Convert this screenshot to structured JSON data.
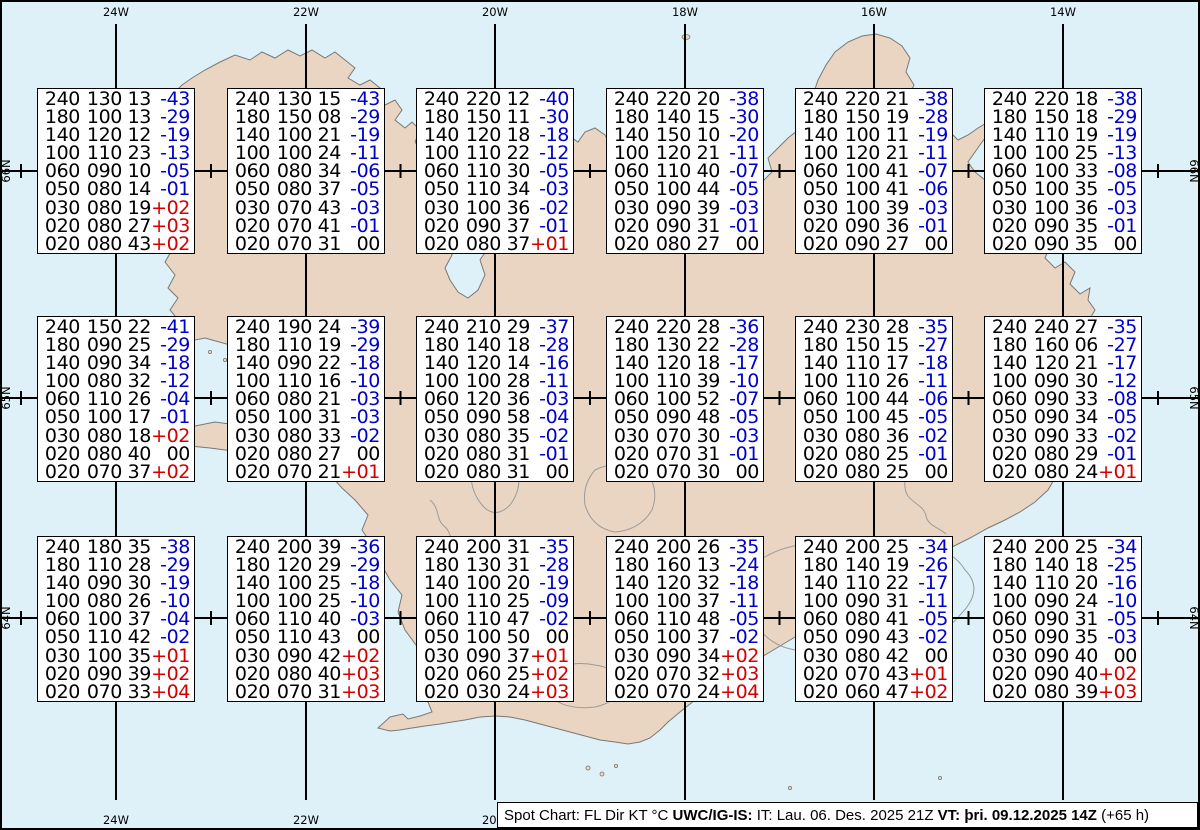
{
  "map": {
    "sea_color": "#def1f8",
    "land_color": "#e9d5c1",
    "coast_color": "#787878",
    "glacier_color": "#9b9b9b",
    "grid_color": "#000000",
    "meridians": [
      {
        "label": "24W",
        "x": 116,
        "bottom_label": true
      },
      {
        "label": "22W",
        "x": 306,
        "bottom_label": true
      },
      {
        "label": "20W",
        "x": 495,
        "bottom_label": true
      },
      {
        "label": "18W",
        "x": 685,
        "bottom_label": false
      },
      {
        "label": "16W",
        "x": 874,
        "bottom_label": false
      },
      {
        "label": "14W",
        "x": 1063,
        "bottom_label": false
      }
    ],
    "parallels": [
      {
        "label": "66N",
        "y": 171
      },
      {
        "label": "65N",
        "y": 398
      },
      {
        "label": "64N",
        "y": 618
      }
    ]
  },
  "columns": [
    "FL",
    "Dir",
    "KT",
    "°C"
  ],
  "stations": [
    {
      "x": 37,
      "y": 88,
      "rows": [
        [
          "240",
          "130",
          "13",
          "-43"
        ],
        [
          "180",
          "100",
          "13",
          "-29"
        ],
        [
          "140",
          "120",
          "12",
          "-19"
        ],
        [
          "100",
          "110",
          "23",
          "-13"
        ],
        [
          "060",
          "090",
          "10",
          "-05"
        ],
        [
          "050",
          "080",
          "14",
          "-01"
        ],
        [
          "030",
          "080",
          "19",
          "+02"
        ],
        [
          "020",
          "080",
          "27",
          "+03"
        ],
        [
          "020",
          "080",
          "43",
          "+02"
        ]
      ]
    },
    {
      "x": 227,
      "y": 88,
      "rows": [
        [
          "240",
          "130",
          "15",
          "-43"
        ],
        [
          "180",
          "150",
          "08",
          "-29"
        ],
        [
          "140",
          "100",
          "21",
          "-19"
        ],
        [
          "100",
          "100",
          "24",
          "-11"
        ],
        [
          "060",
          "080",
          "34",
          "-06"
        ],
        [
          "050",
          "080",
          "37",
          "-05"
        ],
        [
          "030",
          "070",
          "43",
          "-03"
        ],
        [
          "020",
          "070",
          "41",
          "-01"
        ],
        [
          "020",
          "070",
          "31",
          "00"
        ]
      ]
    },
    {
      "x": 416,
      "y": 88,
      "rows": [
        [
          "240",
          "220",
          "12",
          "-40"
        ],
        [
          "180",
          "150",
          "11",
          "-30"
        ],
        [
          "140",
          "120",
          "18",
          "-18"
        ],
        [
          "100",
          "110",
          "22",
          "-12"
        ],
        [
          "060",
          "110",
          "30",
          "-05"
        ],
        [
          "050",
          "110",
          "34",
          "-03"
        ],
        [
          "030",
          "100",
          "36",
          "-02"
        ],
        [
          "020",
          "090",
          "37",
          "-01"
        ],
        [
          "020",
          "080",
          "37",
          "+01"
        ]
      ]
    },
    {
      "x": 606,
      "y": 88,
      "rows": [
        [
          "240",
          "220",
          "20",
          "-38"
        ],
        [
          "180",
          "140",
          "15",
          "-30"
        ],
        [
          "140",
          "150",
          "10",
          "-20"
        ],
        [
          "100",
          "120",
          "21",
          "-11"
        ],
        [
          "060",
          "110",
          "40",
          "-07"
        ],
        [
          "050",
          "100",
          "44",
          "-05"
        ],
        [
          "030",
          "090",
          "39",
          "-03"
        ],
        [
          "020",
          "090",
          "31",
          "-01"
        ],
        [
          "020",
          "080",
          "27",
          "00"
        ]
      ]
    },
    {
      "x": 795,
      "y": 88,
      "rows": [
        [
          "240",
          "220",
          "21",
          "-38"
        ],
        [
          "180",
          "150",
          "19",
          "-28"
        ],
        [
          "140",
          "100",
          "11",
          "-19"
        ],
        [
          "100",
          "120",
          "21",
          "-11"
        ],
        [
          "060",
          "100",
          "41",
          "-07"
        ],
        [
          "050",
          "100",
          "41",
          "-06"
        ],
        [
          "030",
          "100",
          "39",
          "-03"
        ],
        [
          "020",
          "090",
          "36",
          "-01"
        ],
        [
          "020",
          "090",
          "27",
          "00"
        ]
      ]
    },
    {
      "x": 984,
      "y": 88,
      "rows": [
        [
          "240",
          "220",
          "18",
          "-38"
        ],
        [
          "180",
          "150",
          "18",
          "-29"
        ],
        [
          "140",
          "110",
          "19",
          "-19"
        ],
        [
          "100",
          "100",
          "25",
          "-13"
        ],
        [
          "060",
          "100",
          "33",
          "-08"
        ],
        [
          "050",
          "100",
          "35",
          "-05"
        ],
        [
          "030",
          "100",
          "36",
          "-03"
        ],
        [
          "020",
          "090",
          "35",
          "-01"
        ],
        [
          "020",
          "090",
          "35",
          "00"
        ]
      ]
    },
    {
      "x": 37,
      "y": 316,
      "rows": [
        [
          "240",
          "150",
          "22",
          "-41"
        ],
        [
          "180",
          "090",
          "25",
          "-29"
        ],
        [
          "140",
          "090",
          "34",
          "-18"
        ],
        [
          "100",
          "080",
          "32",
          "-12"
        ],
        [
          "060",
          "110",
          "26",
          "-04"
        ],
        [
          "050",
          "100",
          "17",
          "-01"
        ],
        [
          "030",
          "080",
          "18",
          "+02"
        ],
        [
          "020",
          "080",
          "40",
          "00"
        ],
        [
          "020",
          "070",
          "37",
          "+02"
        ]
      ]
    },
    {
      "x": 227,
      "y": 316,
      "rows": [
        [
          "240",
          "190",
          "24",
          "-39"
        ],
        [
          "180",
          "110",
          "19",
          "-29"
        ],
        [
          "140",
          "090",
          "22",
          "-18"
        ],
        [
          "100",
          "110",
          "16",
          "-10"
        ],
        [
          "060",
          "080",
          "21",
          "-03"
        ],
        [
          "050",
          "100",
          "31",
          "-03"
        ],
        [
          "030",
          "080",
          "33",
          "-02"
        ],
        [
          "020",
          "080",
          "27",
          "00"
        ],
        [
          "020",
          "070",
          "21",
          "+01"
        ]
      ]
    },
    {
      "x": 416,
      "y": 316,
      "rows": [
        [
          "240",
          "210",
          "29",
          "-37"
        ],
        [
          "180",
          "140",
          "18",
          "-28"
        ],
        [
          "140",
          "120",
          "14",
          "-16"
        ],
        [
          "100",
          "100",
          "28",
          "-11"
        ],
        [
          "060",
          "120",
          "36",
          "-03"
        ],
        [
          "050",
          "090",
          "58",
          "-04"
        ],
        [
          "030",
          "080",
          "35",
          "-02"
        ],
        [
          "020",
          "080",
          "31",
          "-01"
        ],
        [
          "020",
          "080",
          "31",
          "00"
        ]
      ]
    },
    {
      "x": 606,
      "y": 316,
      "rows": [
        [
          "240",
          "220",
          "28",
          "-36"
        ],
        [
          "180",
          "130",
          "22",
          "-28"
        ],
        [
          "140",
          "120",
          "18",
          "-17"
        ],
        [
          "100",
          "110",
          "39",
          "-10"
        ],
        [
          "060",
          "100",
          "52",
          "-07"
        ],
        [
          "050",
          "090",
          "48",
          "-05"
        ],
        [
          "030",
          "070",
          "30",
          "-03"
        ],
        [
          "020",
          "070",
          "31",
          "-01"
        ],
        [
          "020",
          "070",
          "30",
          "00"
        ]
      ]
    },
    {
      "x": 795,
      "y": 316,
      "rows": [
        [
          "240",
          "230",
          "28",
          "-35"
        ],
        [
          "180",
          "150",
          "15",
          "-27"
        ],
        [
          "140",
          "110",
          "17",
          "-18"
        ],
        [
          "100",
          "110",
          "26",
          "-11"
        ],
        [
          "060",
          "100",
          "44",
          "-06"
        ],
        [
          "050",
          "100",
          "45",
          "-05"
        ],
        [
          "030",
          "080",
          "36",
          "-02"
        ],
        [
          "020",
          "080",
          "25",
          "-01"
        ],
        [
          "020",
          "080",
          "25",
          "00"
        ]
      ]
    },
    {
      "x": 984,
      "y": 316,
      "rows": [
        [
          "240",
          "240",
          "27",
          "-35"
        ],
        [
          "180",
          "160",
          "06",
          "-27"
        ],
        [
          "140",
          "120",
          "21",
          "-17"
        ],
        [
          "100",
          "090",
          "30",
          "-12"
        ],
        [
          "060",
          "090",
          "33",
          "-08"
        ],
        [
          "050",
          "090",
          "34",
          "-05"
        ],
        [
          "030",
          "090",
          "33",
          "-02"
        ],
        [
          "020",
          "080",
          "29",
          "-01"
        ],
        [
          "020",
          "080",
          "24",
          "+01"
        ]
      ]
    },
    {
      "x": 37,
      "y": 536,
      "rows": [
        [
          "240",
          "180",
          "35",
          "-38"
        ],
        [
          "180",
          "110",
          "28",
          "-29"
        ],
        [
          "140",
          "090",
          "30",
          "-19"
        ],
        [
          "100",
          "080",
          "26",
          "-10"
        ],
        [
          "060",
          "100",
          "37",
          "-04"
        ],
        [
          "050",
          "110",
          "42",
          "-02"
        ],
        [
          "030",
          "100",
          "35",
          "+01"
        ],
        [
          "020",
          "090",
          "39",
          "+02"
        ],
        [
          "020",
          "070",
          "33",
          "+04"
        ]
      ]
    },
    {
      "x": 227,
      "y": 536,
      "rows": [
        [
          "240",
          "200",
          "39",
          "-36"
        ],
        [
          "180",
          "120",
          "29",
          "-29"
        ],
        [
          "140",
          "100",
          "25",
          "-18"
        ],
        [
          "100",
          "100",
          "25",
          "-10"
        ],
        [
          "060",
          "110",
          "40",
          "-03"
        ],
        [
          "050",
          "110",
          "43",
          "00"
        ],
        [
          "030",
          "090",
          "42",
          "+02"
        ],
        [
          "020",
          "080",
          "40",
          "+03"
        ],
        [
          "020",
          "070",
          "31",
          "+03"
        ]
      ]
    },
    {
      "x": 416,
      "y": 536,
      "rows": [
        [
          "240",
          "200",
          "31",
          "-35"
        ],
        [
          "180",
          "130",
          "31",
          "-28"
        ],
        [
          "140",
          "100",
          "20",
          "-19"
        ],
        [
          "100",
          "110",
          "25",
          "-09"
        ],
        [
          "060",
          "110",
          "47",
          "-02"
        ],
        [
          "050",
          "100",
          "50",
          "00"
        ],
        [
          "030",
          "090",
          "37",
          "+01"
        ],
        [
          "020",
          "060",
          "25",
          "+02"
        ],
        [
          "020",
          "030",
          "24",
          "+03"
        ]
      ]
    },
    {
      "x": 606,
      "y": 536,
      "rows": [
        [
          "240",
          "200",
          "26",
          "-35"
        ],
        [
          "180",
          "160",
          "13",
          "-24"
        ],
        [
          "140",
          "120",
          "32",
          "-18"
        ],
        [
          "100",
          "100",
          "37",
          "-11"
        ],
        [
          "060",
          "110",
          "48",
          "-05"
        ],
        [
          "050",
          "100",
          "37",
          "-02"
        ],
        [
          "030",
          "090",
          "34",
          "+02"
        ],
        [
          "020",
          "070",
          "32",
          "+03"
        ],
        [
          "020",
          "070",
          "24",
          "+04"
        ]
      ]
    },
    {
      "x": 795,
      "y": 536,
      "rows": [
        [
          "240",
          "200",
          "25",
          "-34"
        ],
        [
          "180",
          "140",
          "19",
          "-26"
        ],
        [
          "140",
          "110",
          "22",
          "-17"
        ],
        [
          "100",
          "090",
          "31",
          "-11"
        ],
        [
          "060",
          "080",
          "41",
          "-05"
        ],
        [
          "050",
          "090",
          "43",
          "-02"
        ],
        [
          "030",
          "080",
          "42",
          "00"
        ],
        [
          "020",
          "070",
          "43",
          "+01"
        ],
        [
          "020",
          "060",
          "47",
          "+02"
        ]
      ]
    },
    {
      "x": 984,
      "y": 536,
      "rows": [
        [
          "240",
          "200",
          "25",
          "-34"
        ],
        [
          "180",
          "140",
          "18",
          "-25"
        ],
        [
          "140",
          "110",
          "20",
          "-16"
        ],
        [
          "100",
          "090",
          "24",
          "-10"
        ],
        [
          "060",
          "090",
          "31",
          "-05"
        ],
        [
          "050",
          "090",
          "35",
          "-03"
        ],
        [
          "030",
          "090",
          "40",
          "00"
        ],
        [
          "020",
          "090",
          "40",
          "+02"
        ],
        [
          "020",
          "080",
          "39",
          "+03"
        ]
      ]
    }
  ],
  "status_bar": {
    "segments": [
      {
        "text": "Spot Chart: FL Dir KT °C ",
        "bold": false
      },
      {
        "text": "UWC/IG-IS:",
        "bold": true
      },
      {
        "text": " IT: Lau. 06. Des. 2025 21Z ",
        "bold": false
      },
      {
        "text": "VT: þri. 09.12.2025 14Z",
        "bold": true
      },
      {
        "text": " (+65 h)",
        "bold": false
      }
    ]
  }
}
